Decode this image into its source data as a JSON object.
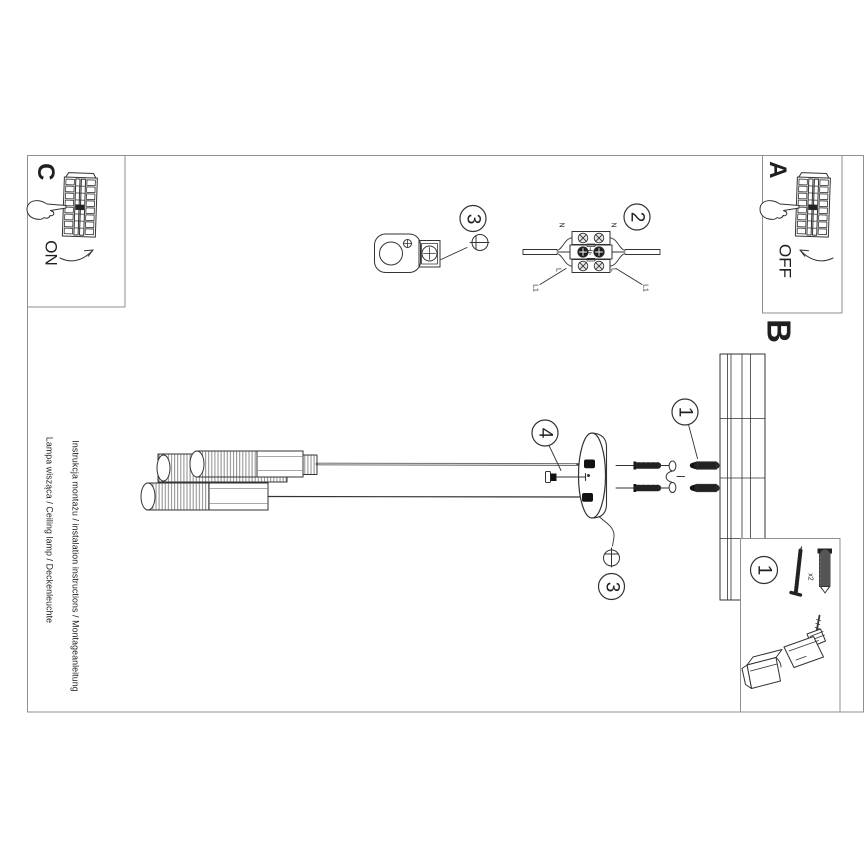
{
  "sheet": {
    "line1": "Instrukcja montażu / instalation instructions / Montageanleitung",
    "line2": "Lampa wisząca / Ceiling lamp / Deckenleuchte"
  },
  "steps": {
    "a": {
      "label": "A",
      "state": "OFF"
    },
    "b": {
      "label": "B"
    },
    "c": {
      "label": "C",
      "state": "ON"
    }
  },
  "callouts": {
    "c1": "1",
    "c2": "2",
    "c3": "3",
    "c4": "4"
  },
  "terminal_block": {
    "neutral": "N",
    "live": "L",
    "wire": "L1"
  },
  "parts": {
    "qty": "x2"
  },
  "colors": {
    "line": "#333333",
    "frame": "#8f8f8f",
    "ink": "#1f1f1f"
  }
}
